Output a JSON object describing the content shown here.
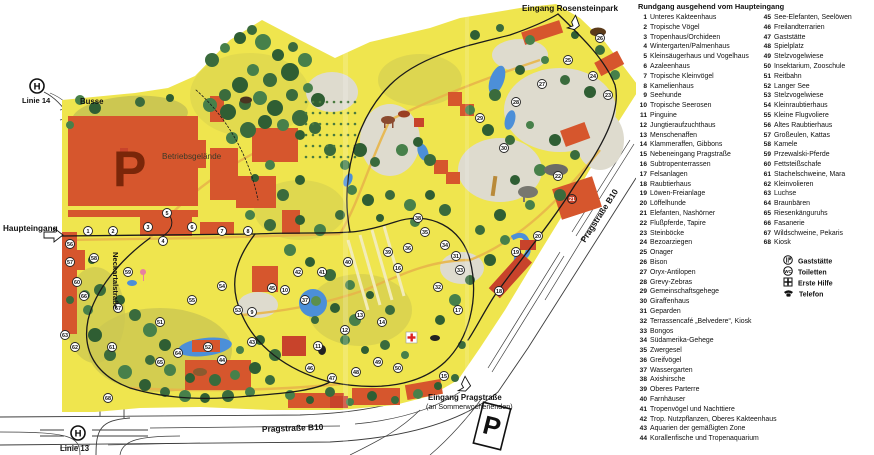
{
  "legend": {
    "title": "Rundgang ausgehend vom Haupteingang",
    "col1": [
      {
        "n": "1",
        "label": "Unteres Kakteenhaus"
      },
      {
        "n": "2",
        "label": "Tropische Vögel"
      },
      {
        "n": "3",
        "label": "Tropenhaus/Orchideen"
      },
      {
        "n": "4",
        "label": "Wintergarten/Palmenhaus"
      },
      {
        "n": "5",
        "label": "Kleinsäugerhaus und Vogelhaus"
      },
      {
        "n": "6",
        "label": "Azaleenhaus"
      },
      {
        "n": "7",
        "label": "Tropische Kleinvögel"
      },
      {
        "n": "8",
        "label": "Kamelienhaus"
      },
      {
        "n": "9",
        "label": "Seehunde"
      },
      {
        "n": "10",
        "label": "Tropische Seerosen"
      },
      {
        "n": "11",
        "label": "Pinguine"
      },
      {
        "n": "12",
        "label": "Jungtieraufzuchthaus"
      },
      {
        "n": "13",
        "label": "Menschenaffen"
      },
      {
        "n": "14",
        "label": "Klammeraffen, Gibbons"
      },
      {
        "n": "15",
        "label": "Nebeneingang Pragstraße"
      },
      {
        "n": "16",
        "label": "Subtropenterrassen"
      },
      {
        "n": "17",
        "label": "Felsanlagen"
      },
      {
        "n": "18",
        "label": "Raubtierhaus"
      },
      {
        "n": "19",
        "label": "Löwen-Freianlage"
      },
      {
        "n": "20",
        "label": "Löffelhunde"
      },
      {
        "n": "21",
        "label": "Elefanten, Nashörner"
      },
      {
        "n": "22",
        "label": "Flußpferde, Tapire"
      },
      {
        "n": "23",
        "label": "Steinböcke"
      },
      {
        "n": "24",
        "label": "Bezoarziegen"
      },
      {
        "n": "25",
        "label": "Onager"
      },
      {
        "n": "26",
        "label": "Bison"
      },
      {
        "n": "27",
        "label": "Oryx-Antilopen"
      },
      {
        "n": "28",
        "label": "Grevy-Zebras"
      },
      {
        "n": "29",
        "label": "Gemeinschaftsgehege"
      },
      {
        "n": "30",
        "label": "Giraffenhaus"
      },
      {
        "n": "31",
        "label": "Geparden"
      },
      {
        "n": "32",
        "label": "Terrassencafé „Belvedere“, Kiosk"
      },
      {
        "n": "33",
        "label": "Bongos"
      },
      {
        "n": "34",
        "label": "Südamerika-Gehege"
      },
      {
        "n": "35",
        "label": "Zwergesel"
      },
      {
        "n": "36",
        "label": "Greifvögel"
      },
      {
        "n": "37",
        "label": "Wassergarten"
      },
      {
        "n": "38",
        "label": "Axishirsche"
      },
      {
        "n": "39",
        "label": "Oberes Parterre"
      },
      {
        "n": "40",
        "label": "Farnhäuser"
      },
      {
        "n": "41",
        "label": "Tropenvögel und Nachttiere"
      },
      {
        "n": "42",
        "label": "Trop. Nutzpflanzen, Oberes Kakteenhaus"
      },
      {
        "n": "43",
        "label": "Aquarien der gemäßigten Zone"
      },
      {
        "n": "44",
        "label": "Korallenfische und Tropenaquarium"
      }
    ],
    "col2": [
      {
        "n": "45",
        "label": "See-Elefanten, Seelöwen"
      },
      {
        "n": "46",
        "label": "Freilandterrarien"
      },
      {
        "n": "47",
        "label": "Gaststätte"
      },
      {
        "n": "48",
        "label": "Spielplatz"
      },
      {
        "n": "49",
        "label": "Stelzvogelwiese"
      },
      {
        "n": "50",
        "label": "Insektarium, Zooschule"
      },
      {
        "n": "51",
        "label": "Reitbahn"
      },
      {
        "n": "52",
        "label": "Langer See"
      },
      {
        "n": "53",
        "label": "Stelzvogelwiese"
      },
      {
        "n": "54",
        "label": "Kleinraubtierhaus"
      },
      {
        "n": "55",
        "label": "Kleine Flugvoliere"
      },
      {
        "n": "56",
        "label": "Altes Raubtierhaus"
      },
      {
        "n": "57",
        "label": "Großeulen, Kattas"
      },
      {
        "n": "58",
        "label": "Kamele"
      },
      {
        "n": "59",
        "label": "Przewalski-Pferde"
      },
      {
        "n": "60",
        "label": "Fettsteißschafe"
      },
      {
        "n": "61",
        "label": "Stachelschweine, Mara"
      },
      {
        "n": "62",
        "label": "Kleinvolieren"
      },
      {
        "n": "63",
        "label": "Luchse"
      },
      {
        "n": "64",
        "label": "Braunbären"
      },
      {
        "n": "65",
        "label": "Riesenkänguruhs"
      },
      {
        "n": "66",
        "label": "Fasanerie"
      },
      {
        "n": "67",
        "label": "Wildschweine, Pekaris"
      },
      {
        "n": "68",
        "label": "Kiosk"
      }
    ],
    "symbols": [
      {
        "icon": "restaurant-icon",
        "label": "Gaststätte"
      },
      {
        "icon": "wc-icon",
        "label": "Toiletten"
      },
      {
        "icon": "first-aid-icon",
        "label": "Erste Hilfe"
      },
      {
        "icon": "phone-icon",
        "label": "Telefon"
      }
    ],
    "wc_text": "WC"
  },
  "map": {
    "labels": {
      "eingang_rosensteinpark": "Eingang Rosensteinpark",
      "linie14": "Linie 14",
      "busse": "Busse",
      "parking_main": "P",
      "betriebsgelaende": "Betriebsgelände",
      "haupteingang": "Haupteingang",
      "neckartalstrasse": "Neckartalstraße",
      "linie13": "Linie 13",
      "pragstrasse_b10_bottom": "Pragstraße B10",
      "pragstrasse_b10_diagonal": "Pragstraße B10",
      "eingang_pragstrasse": "Eingang Pragstraße",
      "sommerwochenenden": "(an Sommerwochenenden)",
      "parking_south": "P",
      "tram_stop": "H"
    },
    "markers": [
      {
        "n": 1,
        "x": 88,
        "y": 231
      },
      {
        "n": 2,
        "x": 113,
        "y": 231
      },
      {
        "n": 3,
        "x": 148,
        "y": 227
      },
      {
        "n": 4,
        "x": 163,
        "y": 241
      },
      {
        "n": 5,
        "x": 167,
        "y": 213
      },
      {
        "n": 6,
        "x": 192,
        "y": 227
      },
      {
        "n": 7,
        "x": 222,
        "y": 231
      },
      {
        "n": 8,
        "x": 248,
        "y": 231
      },
      {
        "n": 9,
        "x": 252,
        "y": 312
      },
      {
        "n": 10,
        "x": 285,
        "y": 290
      },
      {
        "n": 11,
        "x": 318,
        "y": 346
      },
      {
        "n": 12,
        "x": 345,
        "y": 330
      },
      {
        "n": 13,
        "x": 360,
        "y": 315
      },
      {
        "n": 14,
        "x": 382,
        "y": 322
      },
      {
        "n": 15,
        "x": 444,
        "y": 376
      },
      {
        "n": 16,
        "x": 398,
        "y": 268
      },
      {
        "n": 17,
        "x": 458,
        "y": 310
      },
      {
        "n": 18,
        "x": 499,
        "y": 291
      },
      {
        "n": 19,
        "x": 516,
        "y": 252
      },
      {
        "n": 20,
        "x": 538,
        "y": 236
      },
      {
        "n": 21,
        "x": 572,
        "y": 199
      },
      {
        "n": 22,
        "x": 558,
        "y": 176
      },
      {
        "n": 23,
        "x": 608,
        "y": 95
      },
      {
        "n": 24,
        "x": 593,
        "y": 76
      },
      {
        "n": 25,
        "x": 568,
        "y": 60
      },
      {
        "n": 26,
        "x": 600,
        "y": 38
      },
      {
        "n": 27,
        "x": 542,
        "y": 84
      },
      {
        "n": 28,
        "x": 516,
        "y": 102
      },
      {
        "n": 29,
        "x": 480,
        "y": 118
      },
      {
        "n": 30,
        "x": 504,
        "y": 148
      },
      {
        "n": 31,
        "x": 456,
        "y": 256
      },
      {
        "n": 32,
        "x": 438,
        "y": 287
      },
      {
        "n": 33,
        "x": 460,
        "y": 270
      },
      {
        "n": 34,
        "x": 445,
        "y": 245
      },
      {
        "n": 35,
        "x": 425,
        "y": 232
      },
      {
        "n": 36,
        "x": 408,
        "y": 248
      },
      {
        "n": 37,
        "x": 305,
        "y": 300
      },
      {
        "n": 38,
        "x": 418,
        "y": 218
      },
      {
        "n": 39,
        "x": 388,
        "y": 252
      },
      {
        "n": 40,
        "x": 348,
        "y": 262
      },
      {
        "n": 41,
        "x": 322,
        "y": 272
      },
      {
        "n": 42,
        "x": 298,
        "y": 272
      },
      {
        "n": 43,
        "x": 252,
        "y": 342
      },
      {
        "n": 44,
        "x": 222,
        "y": 360
      },
      {
        "n": 45,
        "x": 272,
        "y": 288
      },
      {
        "n": 46,
        "x": 310,
        "y": 368
      },
      {
        "n": 47,
        "x": 332,
        "y": 378
      },
      {
        "n": 48,
        "x": 356,
        "y": 372
      },
      {
        "n": 49,
        "x": 378,
        "y": 362
      },
      {
        "n": 50,
        "x": 398,
        "y": 368
      },
      {
        "n": 51,
        "x": 160,
        "y": 322
      },
      {
        "n": 52,
        "x": 208,
        "y": 347
      },
      {
        "n": 53,
        "x": 238,
        "y": 310
      },
      {
        "n": 54,
        "x": 222,
        "y": 286
      },
      {
        "n": 55,
        "x": 192,
        "y": 300
      },
      {
        "n": 56,
        "x": 70,
        "y": 244
      },
      {
        "n": 57,
        "x": 70,
        "y": 262
      },
      {
        "n": 58,
        "x": 94,
        "y": 258
      },
      {
        "n": 59,
        "x": 128,
        "y": 272
      },
      {
        "n": 60,
        "x": 77,
        "y": 282
      },
      {
        "n": 61,
        "x": 112,
        "y": 347
      },
      {
        "n": 62,
        "x": 75,
        "y": 347
      },
      {
        "n": 63,
        "x": 65,
        "y": 335
      },
      {
        "n": 64,
        "x": 178,
        "y": 353
      },
      {
        "n": 65,
        "x": 160,
        "y": 362
      },
      {
        "n": 66,
        "x": 84,
        "y": 296
      },
      {
        "n": 67,
        "x": 118,
        "y": 308
      },
      {
        "n": 68,
        "x": 108,
        "y": 398
      }
    ],
    "red_markers": [
      21
    ]
  },
  "colors": {
    "map_yellow": "#EFE54E",
    "olive": "#CCC751",
    "enclosure_gray": "#DEDBCE",
    "building_orange": "#D6562D",
    "building_red": "#C8432B",
    "parking_letter": "#7A2609",
    "tree_green": "#3A6B3C",
    "water_blue": "#4C8FD8",
    "path_tan": "#E8B64A",
    "route_black": "#1a1a1a"
  }
}
